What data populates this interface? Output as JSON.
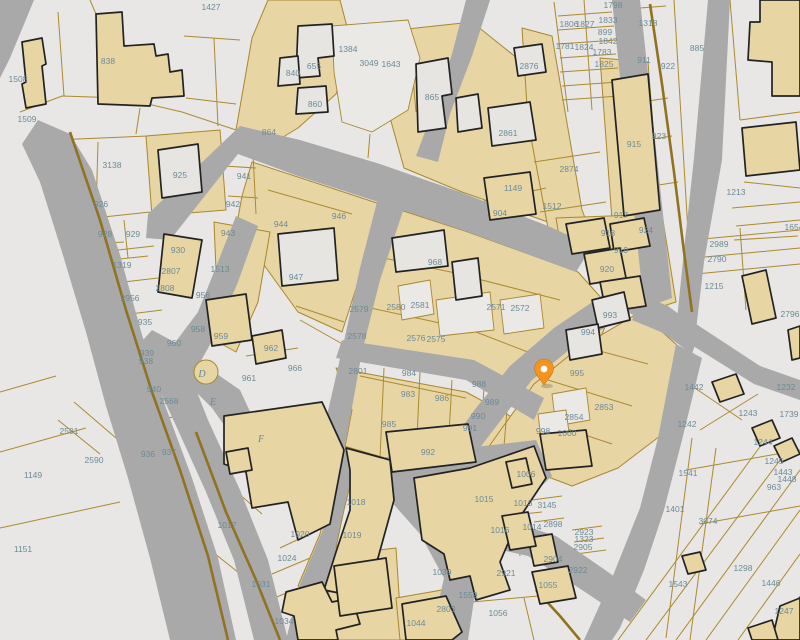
{
  "map": {
    "colors": {
      "background": "#e8e7e5",
      "street": "#a9a9a9",
      "parcel_fill_tan": "#e7d6a4",
      "parcel_line": "#ab8a30",
      "building_outline": "#222222",
      "label_text": "#6d8a96",
      "pin": "#f6921e",
      "pin_dot": "#ffffff"
    },
    "pin": {
      "x": 544,
      "y": 385,
      "color": "#f6921e",
      "dot": "#ffffff"
    },
    "labels": [
      {
        "t": "1427",
        "x": 211,
        "y": 7
      },
      {
        "t": "1508",
        "x": 18,
        "y": 79
      },
      {
        "t": "1509",
        "x": 27,
        "y": 119
      },
      {
        "t": "838",
        "x": 108,
        "y": 61
      },
      {
        "t": "3138",
        "x": 112,
        "y": 165
      },
      {
        "t": "926",
        "x": 101,
        "y": 204
      },
      {
        "t": "925",
        "x": 180,
        "y": 175
      },
      {
        "t": "941",
        "x": 244,
        "y": 176
      },
      {
        "t": "942",
        "x": 233,
        "y": 204
      },
      {
        "t": "928",
        "x": 105,
        "y": 234
      },
      {
        "t": "929",
        "x": 133,
        "y": 234
      },
      {
        "t": "1319",
        "x": 122,
        "y": 265
      },
      {
        "t": "930",
        "x": 178,
        "y": 250
      },
      {
        "t": "2807",
        "x": 171,
        "y": 271
      },
      {
        "t": "2808",
        "x": 165,
        "y": 288
      },
      {
        "t": "943",
        "x": 228,
        "y": 233
      },
      {
        "t": "1513",
        "x": 220,
        "y": 269
      },
      {
        "t": "956",
        "x": 203,
        "y": 295
      },
      {
        "t": "2956",
        "x": 130,
        "y": 298
      },
      {
        "t": "935",
        "x": 145,
        "y": 322
      },
      {
        "t": "958",
        "x": 198,
        "y": 329
      },
      {
        "t": "959",
        "x": 221,
        "y": 336
      },
      {
        "t": "960",
        "x": 174,
        "y": 343
      },
      {
        "t": "939",
        "x": 147,
        "y": 353
      },
      {
        "t": "938",
        "x": 146,
        "y": 361
      },
      {
        "t": "940",
        "x": 154,
        "y": 389
      },
      {
        "t": "2568",
        "x": 169,
        "y": 401
      },
      {
        "t": "962",
        "x": 271,
        "y": 348
      },
      {
        "t": "961",
        "x": 249,
        "y": 378
      },
      {
        "t": "966",
        "x": 295,
        "y": 368
      },
      {
        "t": "2591",
        "x": 69,
        "y": 431
      },
      {
        "t": "2590",
        "x": 94,
        "y": 460
      },
      {
        "t": "1149",
        "x": 33,
        "y": 475
      },
      {
        "t": "1151",
        "x": 23,
        "y": 549
      },
      {
        "t": "936",
        "x": 148,
        "y": 454
      },
      {
        "t": "937",
        "x": 169,
        "y": 452
      },
      {
        "t": "1017",
        "x": 227,
        "y": 525
      },
      {
        "t": "1031",
        "x": 261,
        "y": 584
      },
      {
        "t": "1024",
        "x": 287,
        "y": 558
      },
      {
        "t": "1020",
        "x": 300,
        "y": 534
      },
      {
        "t": "1034",
        "x": 284,
        "y": 621
      },
      {
        "t": "655",
        "x": 314,
        "y": 66
      },
      {
        "t": "840",
        "x": 293,
        "y": 73
      },
      {
        "t": "860",
        "x": 315,
        "y": 104
      },
      {
        "t": "864",
        "x": 269,
        "y": 132
      },
      {
        "t": "1384",
        "x": 348,
        "y": 49
      },
      {
        "t": "3049",
        "x": 369,
        "y": 63
      },
      {
        "t": "1643",
        "x": 391,
        "y": 64
      },
      {
        "t": "865",
        "x": 432,
        "y": 97
      },
      {
        "t": "2861",
        "x": 508,
        "y": 133
      },
      {
        "t": "2876",
        "x": 529,
        "y": 66
      },
      {
        "t": "1149",
        "x": 513,
        "y": 188
      },
      {
        "t": "904",
        "x": 500,
        "y": 213
      },
      {
        "t": "946",
        "x": 339,
        "y": 216
      },
      {
        "t": "944",
        "x": 281,
        "y": 224
      },
      {
        "t": "947",
        "x": 296,
        "y": 277
      },
      {
        "t": "1512",
        "x": 552,
        "y": 206
      },
      {
        "t": "2874",
        "x": 569,
        "y": 169
      },
      {
        "t": "1798",
        "x": 613,
        "y": 5
      },
      {
        "t": "1833",
        "x": 608,
        "y": 20
      },
      {
        "t": "1318",
        "x": 648,
        "y": 23
      },
      {
        "t": "1806",
        "x": 569,
        "y": 24
      },
      {
        "t": "1827",
        "x": 585,
        "y": 24
      },
      {
        "t": "899",
        "x": 605,
        "y": 32
      },
      {
        "t": "1842",
        "x": 608,
        "y": 41
      },
      {
        "t": "1781",
        "x": 565,
        "y": 46
      },
      {
        "t": "1824",
        "x": 584,
        "y": 47
      },
      {
        "t": "1783",
        "x": 602,
        "y": 52
      },
      {
        "t": "1825",
        "x": 604,
        "y": 64
      },
      {
        "t": "911",
        "x": 644,
        "y": 60
      },
      {
        "t": "922",
        "x": 668,
        "y": 66
      },
      {
        "t": "885",
        "x": 697,
        "y": 48
      },
      {
        "t": "915",
        "x": 634,
        "y": 144
      },
      {
        "t": "923",
        "x": 659,
        "y": 136
      },
      {
        "t": "917",
        "x": 621,
        "y": 215
      },
      {
        "t": "1213",
        "x": 736,
        "y": 192
      },
      {
        "t": "1654",
        "x": 794,
        "y": 227
      },
      {
        "t": "918",
        "x": 608,
        "y": 233
      },
      {
        "t": "919",
        "x": 621,
        "y": 250
      },
      {
        "t": "920",
        "x": 607,
        "y": 269
      },
      {
        "t": "924",
        "x": 646,
        "y": 230
      },
      {
        "t": "2989",
        "x": 719,
        "y": 244
      },
      {
        "t": "2790",
        "x": 717,
        "y": 259
      },
      {
        "t": "1215",
        "x": 714,
        "y": 286
      },
      {
        "t": "2796",
        "x": 790,
        "y": 314
      },
      {
        "t": "968",
        "x": 435,
        "y": 262
      },
      {
        "t": "2580",
        "x": 396,
        "y": 307
      },
      {
        "t": "2581",
        "x": 420,
        "y": 305
      },
      {
        "t": "2571",
        "x": 496,
        "y": 307
      },
      {
        "t": "2572",
        "x": 520,
        "y": 308
      },
      {
        "t": "2579",
        "x": 359,
        "y": 309
      },
      {
        "t": "2578",
        "x": 357,
        "y": 336
      },
      {
        "t": "2576",
        "x": 416,
        "y": 338
      },
      {
        "t": "2575",
        "x": 436,
        "y": 339
      },
      {
        "t": "2801",
        "x": 358,
        "y": 371
      },
      {
        "t": "984",
        "x": 409,
        "y": 373
      },
      {
        "t": "983",
        "x": 408,
        "y": 394
      },
      {
        "t": "985",
        "x": 389,
        "y": 424
      },
      {
        "t": "986",
        "x": 442,
        "y": 398
      },
      {
        "t": "988",
        "x": 479,
        "y": 384
      },
      {
        "t": "989",
        "x": 492,
        "y": 402
      },
      {
        "t": "990",
        "x": 478,
        "y": 416
      },
      {
        "t": "991",
        "x": 470,
        "y": 428
      },
      {
        "t": "992",
        "x": 428,
        "y": 452
      },
      {
        "t": "993",
        "x": 610,
        "y": 315
      },
      {
        "t": "994",
        "x": 588,
        "y": 332
      },
      {
        "t": "995",
        "x": 577,
        "y": 373
      },
      {
        "t": "2853",
        "x": 604,
        "y": 407
      },
      {
        "t": "2854",
        "x": 574,
        "y": 417
      },
      {
        "t": "998",
        "x": 543,
        "y": 431
      },
      {
        "t": "1000",
        "x": 567,
        "y": 433
      },
      {
        "t": "1018",
        "x": 356,
        "y": 502
      },
      {
        "t": "1019",
        "x": 352,
        "y": 535
      },
      {
        "t": "1039",
        "x": 442,
        "y": 572
      },
      {
        "t": "1006",
        "x": 526,
        "y": 474
      },
      {
        "t": "1015",
        "x": 484,
        "y": 499
      },
      {
        "t": "1013",
        "x": 523,
        "y": 503
      },
      {
        "t": "1016",
        "x": 500,
        "y": 530
      },
      {
        "t": "1014",
        "x": 532,
        "y": 527
      },
      {
        "t": "1044",
        "x": 416,
        "y": 623
      },
      {
        "t": "1056",
        "x": 498,
        "y": 613
      },
      {
        "t": "1055",
        "x": 548,
        "y": 585
      },
      {
        "t": "1559",
        "x": 468,
        "y": 595
      },
      {
        "t": "2803",
        "x": 446,
        "y": 609
      },
      {
        "t": "2921",
        "x": 506,
        "y": 573
      },
      {
        "t": "2922",
        "x": 578,
        "y": 570
      },
      {
        "t": "2904",
        "x": 553,
        "y": 559
      },
      {
        "t": "2923",
        "x": 584,
        "y": 532
      },
      {
        "t": "1323",
        "x": 584,
        "y": 539
      },
      {
        "t": "2905",
        "x": 583,
        "y": 547
      },
      {
        "t": "3145",
        "x": 547,
        "y": 505
      },
      {
        "t": "2898",
        "x": 553,
        "y": 524
      },
      {
        "t": "1541",
        "x": 688,
        "y": 473
      },
      {
        "t": "1401",
        "x": 675,
        "y": 509
      },
      {
        "t": "3074",
        "x": 708,
        "y": 521
      },
      {
        "t": "1543",
        "x": 678,
        "y": 584
      },
      {
        "t": "1298",
        "x": 743,
        "y": 568
      },
      {
        "t": "1446",
        "x": 771,
        "y": 583
      },
      {
        "t": "1247",
        "x": 784,
        "y": 611
      },
      {
        "t": "1242",
        "x": 687,
        "y": 424
      },
      {
        "t": "1243",
        "x": 748,
        "y": 413
      },
      {
        "t": "1232",
        "x": 786,
        "y": 387
      },
      {
        "t": "1442",
        "x": 694,
        "y": 387
      },
      {
        "t": "1244",
        "x": 763,
        "y": 442
      },
      {
        "t": "1245",
        "x": 774,
        "y": 461
      },
      {
        "t": "1443",
        "x": 783,
        "y": 472
      },
      {
        "t": "1448",
        "x": 787,
        "y": 479
      },
      {
        "t": "963",
        "x": 774,
        "y": 487
      },
      {
        "t": "1739",
        "x": 789,
        "y": 414
      }
    ],
    "letters": [
      {
        "t": "D",
        "x": 202,
        "y": 374
      },
      {
        "t": "E",
        "x": 213,
        "y": 402
      },
      {
        "t": "F",
        "x": 261,
        "y": 439
      }
    ],
    "tan_areas": [
      "268,0 340,0 352,46 336,94 298,128 258,152 236,130 252,38",
      "252,162 380,204 362,270 342,332 298,312 256,254 238,218 242,196",
      "398,30 472,22 522,62 550,122 560,174 548,222 462,192 404,168 384,96",
      "522,28 552,36 582,210 612,288 588,246 548,228 528,122",
      "600,58 648,62 660,214 612,220",
      "556,218 662,214 676,302 638,314 606,288 588,250 560,242",
      "382,204 468,232 578,272 612,310 598,344 552,404 474,368 346,344 362,268 380,224",
      "336,368 466,392 532,428 526,446 378,460 344,452 352,410",
      "640,312 678,346 660,436 618,468 572,486 530,470 478,462 502,428 534,384 576,350",
      "344,446 392,460 392,500 376,560 352,598 320,592 298,586 320,534 340,452",
      "326,556 396,548 402,640 318,640 314,596",
      "396,598 442,590 470,600 462,640 400,640",
      "214,222 270,232 258,302 236,352 200,332 216,270",
      "146,136 220,130 226,210 152,216"
    ],
    "parcel_lines": [
      "20,112 62,96 122,98 182,112 236,130",
      "64,96 58,12",
      "184,36 240,40",
      "186,98 236,104",
      "214,38 218,126",
      "140,108 136,134",
      "96,14 90,0",
      "224,166 256,168",
      "228,196 258,198",
      "252,134 256,214",
      "54,140 148,136",
      "98,142 96,214",
      "94,218 150,212",
      "92,262 148,256",
      "124,220 128,258",
      "94,244 124,242",
      "100,252 154,246",
      "106,284 158,278",
      "114,316 162,310",
      "146,366 172,362",
      "150,394 176,390",
      "154,420 180,416",
      "246,356 298,348",
      "230,420 292,408",
      "300,320 346,346",
      "262,446 300,430",
      "0,452 86,428",
      "0,528 120,502",
      "0,392 56,376",
      "58,420 100,454",
      "74,402 116,438",
      "214,472 262,514",
      "200,542 258,588",
      "280,548 318,530",
      "272,574 310,558",
      "264,602 304,586",
      "352,24 356,122",
      "356,42 398,34",
      "408,20 416,112",
      "370,134 368,158",
      "462,206 546,188",
      "534,162 600,152",
      "540,212 606,202",
      "548,258 602,250",
      "554,2 568,112",
      "558,16 612,12",
      "558,30 614,26",
      "558,44 616,40",
      "560,58 616,54",
      "560,72 618,68",
      "562,86 618,82",
      "562,100 620,96",
      "584,0 592,110",
      "640,8 666,6",
      "642,102 668,98",
      "646,140 672,136",
      "652,186 678,182",
      "674,0 692,298",
      "730,0 740,120",
      "740,120 800,112",
      "744,182 800,188",
      "736,226 800,220",
      "740,228 746,310",
      "732,208 800,202",
      "734,240 798,236",
      "692,240 800,230",
      "694,258 800,248",
      "696,274 800,264",
      "618,640 762,444",
      "646,640 786,452",
      "676,640 800,470",
      "706,640 800,510",
      "738,640 800,554",
      "766,640 800,596",
      "692,438 666,638",
      "716,448 690,640",
      "686,470 800,450",
      "700,524 800,506",
      "686,382 742,420",
      "700,430 758,394",
      "482,494 540,488",
      "486,518 542,512",
      "490,542 546,536",
      "514,486 520,556",
      "532,500 562,496",
      "534,522 564,518",
      "572,530 602,526",
      "574,542 604,538",
      "576,554 606,550",
      "472,602 560,594",
      "524,598 534,640",
      "364,254 470,276",
      "474,278 560,300",
      "352,304 472,330",
      "476,332 538,356",
      "360,376 466,398",
      "384,368 380,458",
      "420,372 416,460",
      "452,380 448,452",
      "484,388 480,446",
      "508,398 504,446",
      "566,342 648,364",
      "548,380 632,406",
      "540,420 612,444",
      "268,190 352,214",
      "296,306 344,322"
    ],
    "streets": [
      "0,0 34,0 10,58 0,78",
      "38,120 70,134 92,170 120,255 142,335 166,408 192,478 218,558 236,640 170,640 150,558 128,478 106,406 86,332 62,252 40,182 22,144",
      "148,214 240,126 300,140 380,164 460,192 548,226 592,246 576,272 468,232 378,202 298,176 238,154 170,240 146,238",
      "612,0 640,0 672,298 644,308",
      "708,0 730,0 722,160 704,262 696,330 676,330 684,250 694,158",
      "642,298 696,324 760,366 800,380 800,400 754,384 690,344 632,320",
      "610,282 668,306 700,330 692,354 648,322 606,302",
      "616,286 638,308 574,346 532,380 498,424 472,458 450,444 476,408 510,366 554,328",
      "342,340 474,360 544,398 534,420 466,380 336,358",
      "378,198 404,208 380,280 362,352 344,452 320,446 342,350 360,268",
      "378,458 536,440 552,476 506,520 488,566 474,600 468,640 430,640 444,578 420,534 388,498",
      "342,450 380,462 388,496 354,540 330,590 320,640 286,640 300,584 322,532",
      "506,520 556,536 608,572 646,600 630,622 576,586 528,556 492,548",
      "676,344 702,358 682,440 664,510 644,570 620,628 612,640 584,640 612,578 640,508 658,438",
      "152,330 178,344 208,420 240,490 268,560 288,640 254,640 234,560 206,492 178,430 154,378 136,348",
      "236,216 258,226 238,282 216,334 198,366 174,344 198,312 218,262",
      "174,344 240,390 264,442 246,456 212,408 170,366",
      "466,0 490,0 472,56 450,114 438,162 416,156 434,108 452,54"
    ],
    "thick_paths": [
      "70,132 100,220 126,310 152,392 180,470 208,556 228,640",
      "650,4 662,84 674,172 684,252 692,312",
      "196,432 226,512 256,580 280,640",
      "536,590 560,616 580,640"
    ],
    "white_patches": [
      "332,26 408,20 420,58 408,110 372,132 342,122 334,72",
      "398,286 430,280 434,314 402,320",
      "436,300 490,292 494,330 440,336",
      "500,300 540,294 544,328 504,334",
      "552,394 586,388 590,420 556,426",
      "538,414 566,410 570,440 542,446",
      "350,486 372,492 366,532 348,560 336,548 344,510",
      "432,490 450,486 452,540 434,544"
    ],
    "buildings_tan": [
      "96,14 122,12 124,46 154,44 156,56 168,54 170,72 182,70 184,96 152,98 150,106 98,104",
      "22,42 42,38 46,64 42,66 46,104 26,108 22,84 26,82",
      "612,80 648,74 660,210 624,216",
      "610,224 644,218 650,246 614,252",
      "566,224 604,218 610,248 572,254",
      "584,254 620,248 626,278 590,284",
      "600,282 640,276 646,306 606,312",
      "224,416 322,402 344,450 330,524 298,540 288,502 252,508 246,472 224,464",
      "346,448 390,460 394,500 378,558 354,596 324,590 336,552 350,510 350,470",
      "414,478 470,468 534,446 546,478 518,520 500,562 510,590 476,600 470,576 450,580 444,554 422,540",
      "386,432 468,424 476,462 392,472",
      "402,604 446,596 462,632 452,640 406,640",
      "286,592 322,582 332,602 352,598 360,624 336,630 338,640 298,640 294,616 282,612",
      "334,566 386,558 392,608 340,616",
      "532,572 568,566 576,598 540,604",
      "540,434 586,430 592,466 546,470",
      "528,538 552,534 558,562 534,566",
      "682,556 700,552 706,570 688,574",
      "712,382 736,374 744,394 720,402",
      "752,428 772,420 780,438 760,446",
      "774,446 792,438 800,454 782,462",
      "780,606 800,598 800,640 772,640",
      "748,628 772,620 778,640 752,640",
      "760,0 800,0 800,96 772,96 772,62 748,60 750,22 760,22",
      "742,128 796,122 800,170 746,176",
      "742,276 766,270 776,318 752,324",
      "788,330 800,326 800,358 792,360",
      "484,178 530,172 536,214 490,220",
      "252,336 282,330 286,358 256,364",
      "206,300 246,294 252,340 212,346",
      "164,234 202,240 192,298 158,292",
      "506,462 526,458 532,484 512,488",
      "502,516 528,512 536,546 510,550",
      "226,452 248,448 252,470 230,474"
    ],
    "buildings_gray": [
      "298,26 332,24 334,56 318,58 320,76 296,78",
      "280,58 298,56 300,84 278,86",
      "298,88 326,86 328,112 296,114",
      "416,64 448,58 452,94 442,96 446,128 418,132",
      "456,98 478,94 482,128 458,132",
      "488,108 530,102 536,140 492,146",
      "278,234 334,228 338,280 282,286",
      "158,150 198,144 202,192 162,198",
      "514,48 542,44 546,72 518,76",
      "392,238 444,230 448,266 396,272",
      "452,262 478,258 482,296 456,300",
      "592,300 624,292 630,320 598,328",
      "566,330 598,324 602,354 570,360"
    ],
    "circles": [
      {
        "cx": 206,
        "cy": 372,
        "r": 12
      }
    ]
  }
}
